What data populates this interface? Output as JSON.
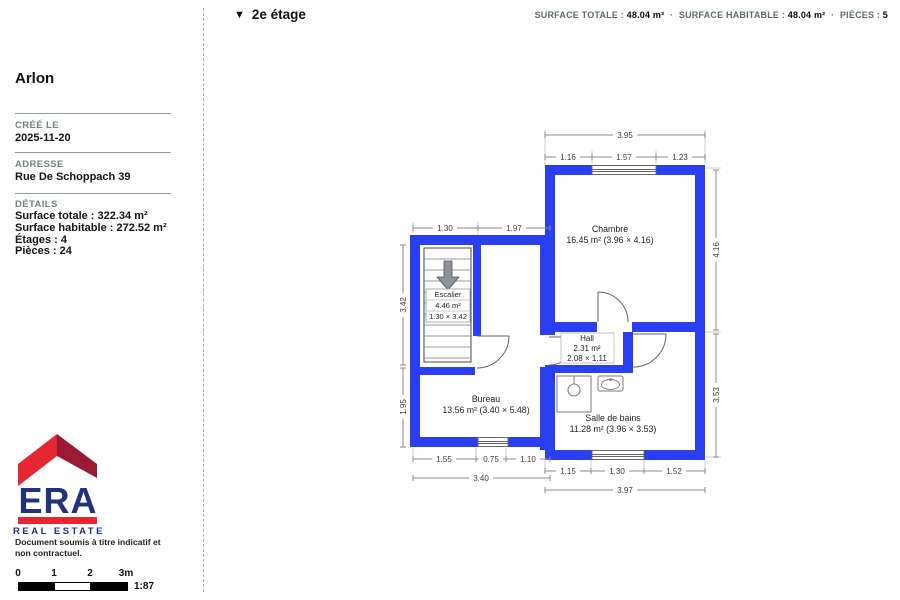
{
  "header": {
    "floor_toggle_icon": "▼",
    "floor_label": "2e étage",
    "stats": {
      "surface_totale_label": "SURFACE TOTALE :",
      "surface_totale_value": "48.04 m²",
      "separator": "·",
      "surface_habitable_label": "SURFACE HABITABLE :",
      "surface_habitable_value": "48.04 m²",
      "pieces_label": "PIÈCES :",
      "pieces_value": "5"
    }
  },
  "sidebar": {
    "title": "Arlon",
    "created_label": "CRÉÉ LE",
    "created_value": "2025-11-20",
    "address_label": "ADRESSE",
    "address_value": "Rue De Schoppach 39",
    "details_label": "DÉTAILS",
    "details": [
      "Surface totale : 322.34 m²",
      "Surface habitable : 272.52 m²",
      "Étages : 4",
      "Pièces : 24"
    ],
    "disclaimer": "Document soumis à titre indicatif et non contractuel."
  },
  "logo": {
    "brand": "ERA",
    "tagline": "REAL ESTATE",
    "colors": {
      "red": "#E62631",
      "maroon": "#9A1B33",
      "navy": "#20317E"
    }
  },
  "scalebar": {
    "tick0": "0",
    "tick1": "1",
    "tick2": "2",
    "tick3": "3m",
    "ratio": "1:87"
  },
  "plan": {
    "wall_color": "#2A3FF2",
    "rooms": {
      "chambre": {
        "name": "Chambre",
        "area": "16.45 m² (3.96 × 4.16)"
      },
      "escalier": {
        "name": "Escalier",
        "area": "4.46 m²",
        "size": "1.30 × 3.42"
      },
      "hall": {
        "name": "Hall",
        "area": "2.31 m²",
        "size": "2.08 × 1.11"
      },
      "bureau": {
        "name": "Bureau",
        "area": "13.56 m² (3.40 × 5.48)"
      },
      "salle_de_bains": {
        "name": "Salle de bains",
        "area": "11.28 m² (3.96 × 3.53)"
      }
    },
    "dims": {
      "top_total": "3.95",
      "top_seg1": "1.16",
      "top_seg2": "1.57",
      "top_seg3": "1.23",
      "left_wing_top_seg1": "1.30",
      "left_wing_top_seg2": "1.97",
      "left_v_top": "3.42",
      "left_v_bottom": "1.95",
      "right_v_top": "4.16",
      "right_v_bottom": "3.53",
      "bottom_left_seg1": "1.55",
      "bottom_left_seg2": "0.75",
      "bottom_left_seg3": "1.10",
      "bottom_left_total": "3.40",
      "bottom_right_seg1": "1.15",
      "bottom_right_seg2": "1.30",
      "bottom_right_seg3": "1.52",
      "bottom_right_total": "3.97"
    }
  }
}
